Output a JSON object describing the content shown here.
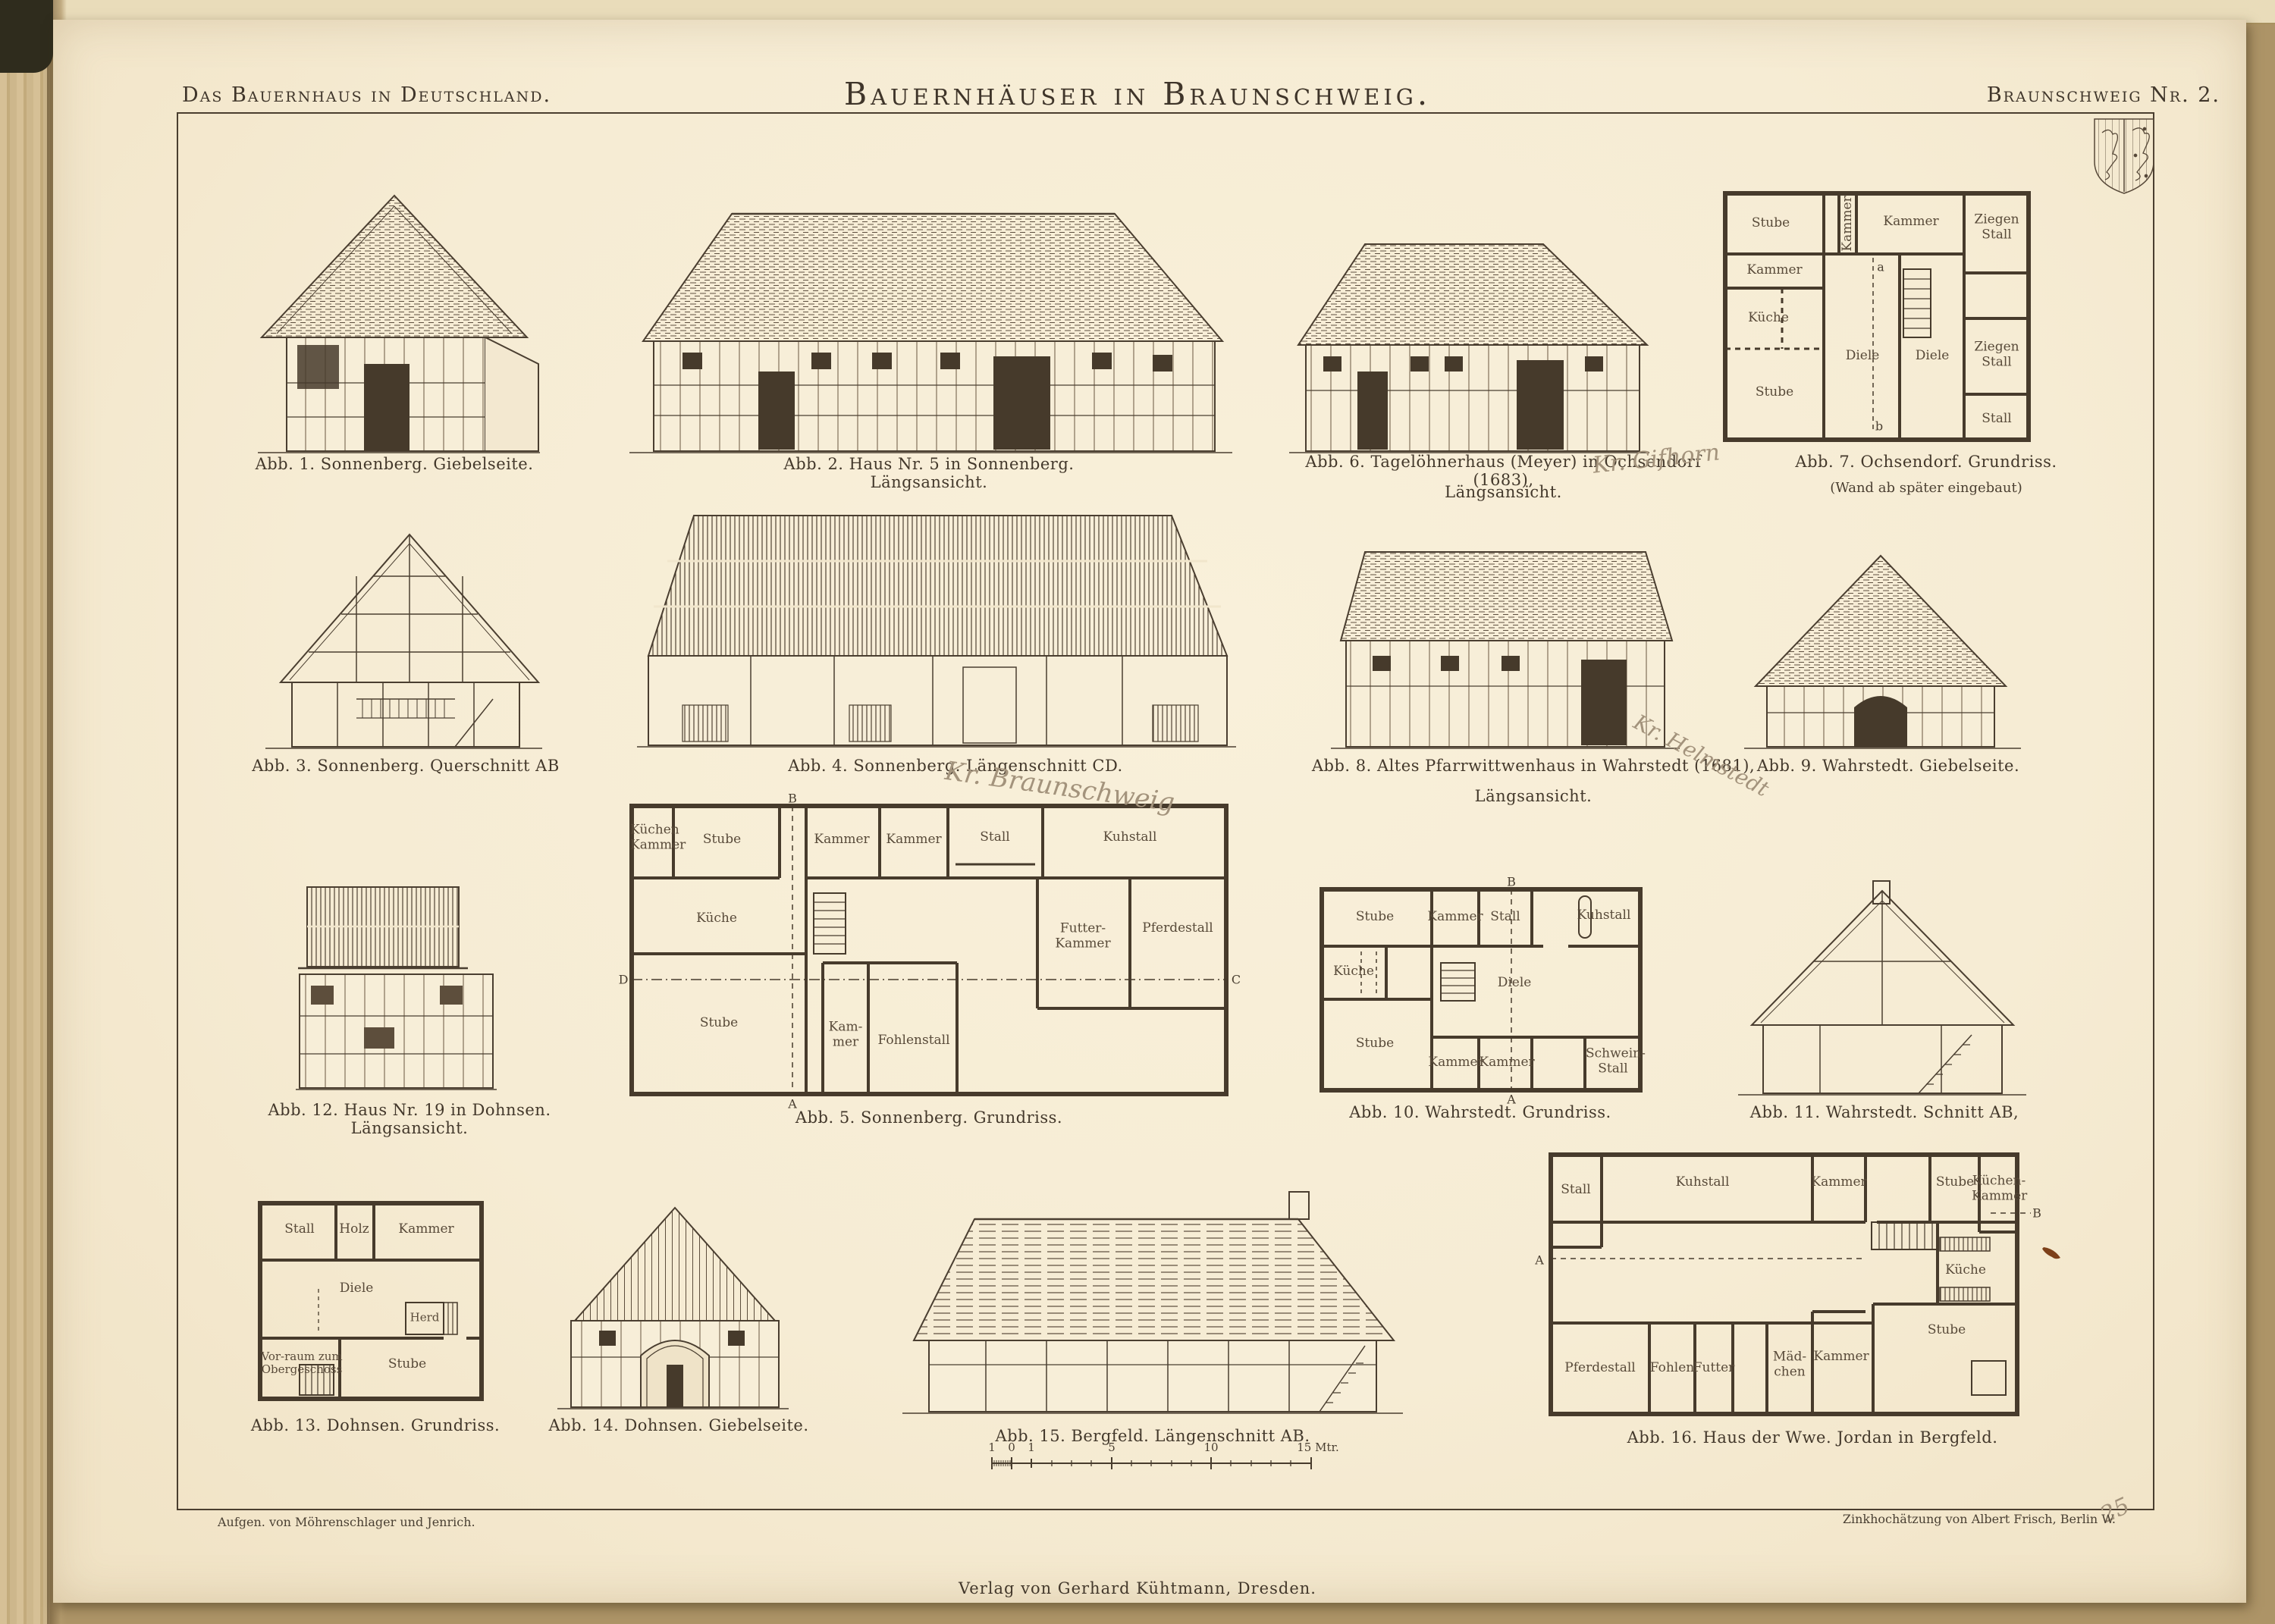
{
  "page": {
    "header_left": "Das Bauernhaus in Deutschland.",
    "title": "Bauernhäuser in Braunschweig.",
    "header_right": "Braunschweig Nr. 2.",
    "footer_left": "Aufgen. von Möhrenschlager und Jenrich.",
    "footer_right": "Zinkhochätzung von Albert Frisch, Berlin W.",
    "footer_center": "Verlag von Gerhard Kühtmann, Dresden."
  },
  "pencil_notes": {
    "f6": "Kr. Gifhorn",
    "f4": "Kr. Braunschweig",
    "f8": "Kr. Helmstedt",
    "corner": "25"
  },
  "figures": {
    "f1": {
      "caption": "Abb. 1.  Sonnenberg.  Giebelseite."
    },
    "f2": {
      "caption": "Abb. 2.  Haus Nr. 5 in Sonnenberg.  Längsansicht."
    },
    "f3": {
      "caption": "Abb. 3.  Sonnenberg.  Querschnitt AB"
    },
    "f4": {
      "caption": "Abb. 4.  Sonnenberg.  Längenschnitt CD."
    },
    "f5": {
      "caption": "Abb. 5.  Sonnenberg.  Grundriss.",
      "rooms": {
        "kuechen_kammer": "Küchen Kammer",
        "stube_top": "Stube",
        "kammer_1": "Kammer",
        "kammer_2": "Kammer",
        "stall": "Stall",
        "kuhstall": "Kuhstall",
        "kueche": "Küche",
        "futter_kammer": "Futter-Kammer",
        "pferdestall": "Pferdestall",
        "stube_bottom": "Stube",
        "kam_mer": "Kam-mer",
        "fohlenstall": "Fohlenstall"
      },
      "markers": {
        "a": "A",
        "b": "B",
        "c": "C",
        "d": "D"
      }
    },
    "f6": {
      "caption_1": "Abb. 6.  Tagelöhnerhaus (Meyer) in Ochsendorf (1683),",
      "caption_2": "Längsansicht."
    },
    "f7": {
      "caption_1": "Abb. 7.  Ochsendorf.  Grundriss.",
      "caption_2": "(Wand ab später eingebaut)",
      "rooms": {
        "stube_top": "Stube",
        "kammer_vert": "Kammer",
        "kammer_top": "Kammer",
        "ziegenstall_top": "Ziegen Stall",
        "kammer_left": "Kammer",
        "kueche": "Küche",
        "diele_1": "Diele",
        "diele_2": "Diele",
        "ziegenstall_mid": "Ziegen Stall",
        "stube_bottom": "Stube",
        "stall": "Stall"
      },
      "markers": {
        "a": "a",
        "b": "b"
      }
    },
    "f8": {
      "caption_1": "Abb. 8.  Altes Pfarrwittwenhaus in Wahrstedt (1681),",
      "caption_2": "Längsansicht."
    },
    "f9": {
      "caption": "Abb. 9.  Wahrstedt.  Giebelseite."
    },
    "f10": {
      "caption": "Abb. 10.  Wahrstedt.  Grundriss.",
      "rooms": {
        "stube_top": "Stube",
        "kammer_top": "Kammer",
        "stall": "Stall",
        "kuhstall": "Kuhstall",
        "kueche": "Küche",
        "diele": "Diele",
        "stube_bottom": "Stube",
        "kammer_b1": "Kammer",
        "kammer_b2": "Kammer",
        "schwein_stall": "Schwein-Stall"
      },
      "markers": {
        "b": "B",
        "a": "A"
      }
    },
    "f11": {
      "caption": "Abb. 11.  Wahrstedt.  Schnitt AB,"
    },
    "f12": {
      "caption": "Abb. 12.  Haus Nr. 19 in Dohnsen.  Längsansicht."
    },
    "f13": {
      "caption": "Abb. 13.  Dohnsen.  Grundriss.",
      "rooms": {
        "stall": "Stall",
        "holz": "Holz",
        "kammer": "Kammer",
        "diele": "Diele",
        "herd": "Herd",
        "vorraum": "Vor-raum zum Obergeschoss",
        "stube": "Stube"
      }
    },
    "f14": {
      "caption": "Abb. 14.  Dohnsen.  Giebelseite."
    },
    "f15": {
      "caption": "Abb. 15.  Bergfeld.  Längenschnitt AB."
    },
    "f16": {
      "caption": "Abb. 16.  Haus der Wwe. Jordan in Bergfeld.",
      "rooms": {
        "stall": "Stall",
        "kuhstall": "Kuhstall",
        "kammer_top": "Kammer",
        "stube_top": "Stube",
        "kuechen_kammer": "Küchen-Kammer",
        "kueche": "Küche",
        "stube_right": "Stube",
        "pferdestall": "Pferdestall",
        "fohlen": "Fohlen",
        "futter": "Futter",
        "maedchen": "Mäd-chen",
        "kammer_bottom": "Kammer"
      },
      "markers": {
        "a": "A",
        "b": "B"
      }
    }
  },
  "scale_bar": {
    "labels": [
      "1",
      "0",
      "1",
      "5",
      "10",
      "15 Mtr."
    ]
  },
  "colors": {
    "paper": "#f6ecd4",
    "ink": "#473b2c",
    "pencil": "#a3937c",
    "blot": "#7d4019"
  }
}
